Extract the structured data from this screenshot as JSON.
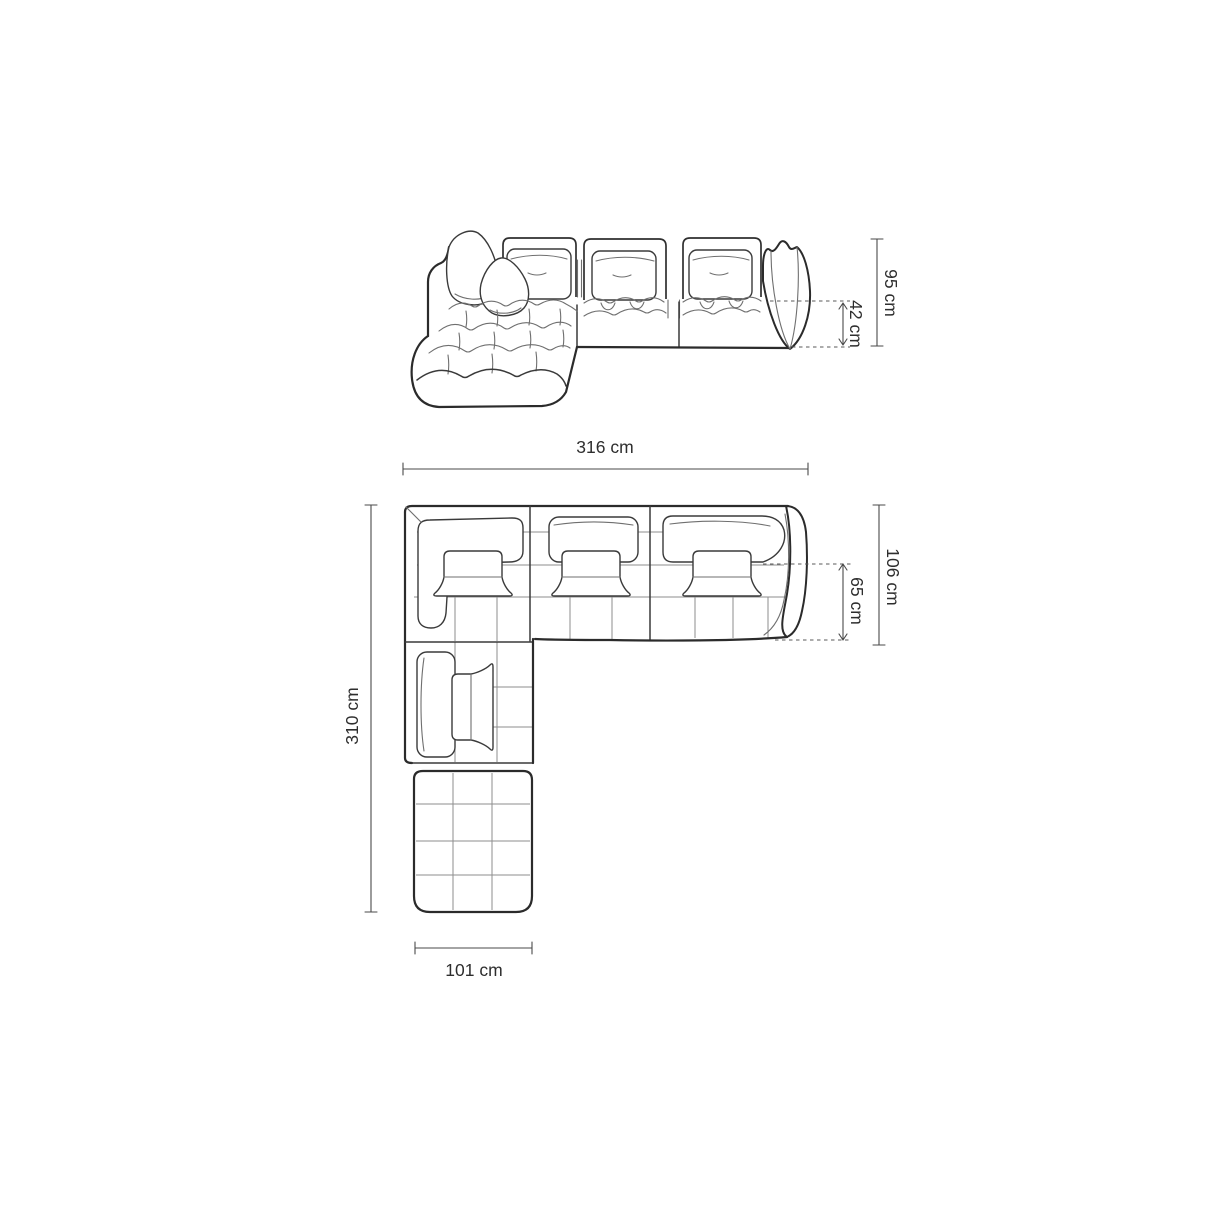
{
  "colors": {
    "background": "#ffffff",
    "outline": "#2b2b2b",
    "dimension_line": "#4a4a4a",
    "label": "#2e2e2e"
  },
  "dims": {
    "elevation": {
      "total_height": "95 cm",
      "seat_height": "42 cm"
    },
    "plan": {
      "total_width": "316 cm",
      "total_depth": "106 cm",
      "seat_depth": "65 cm",
      "total_length": "310 cm",
      "chaise_width": "101 cm"
    }
  }
}
